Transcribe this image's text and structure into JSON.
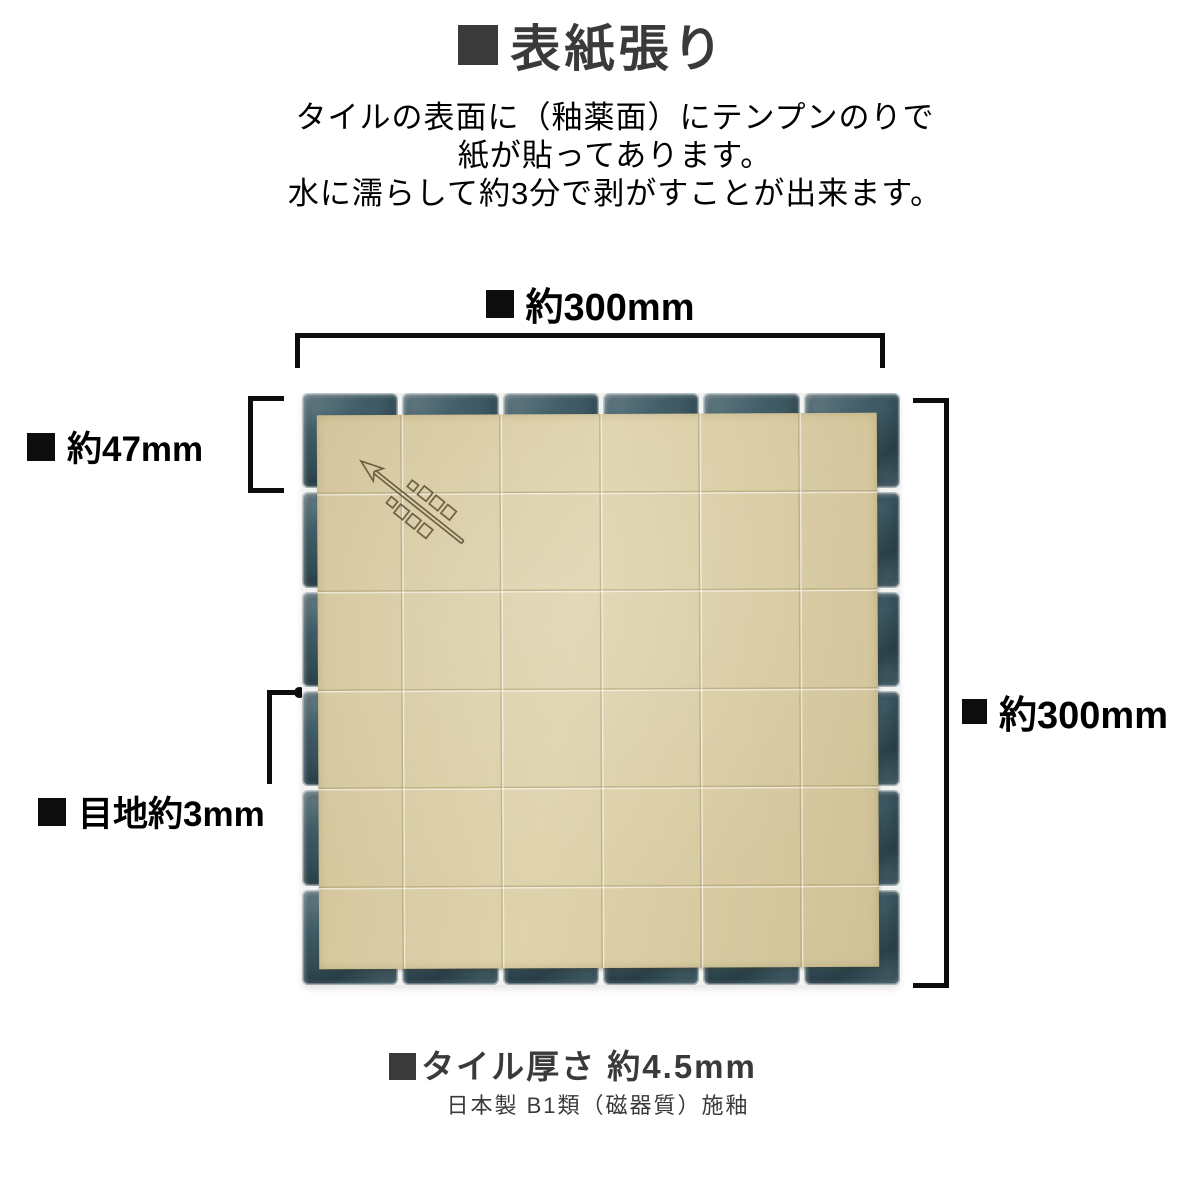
{
  "title": {
    "text": "表紙張り"
  },
  "description": {
    "line1": "タイルの表面に（釉薬面）にテンプンのりで",
    "line2": "紙が貼ってあります。",
    "line3": "水に濡らして約3分で剥がすことが出来ます。"
  },
  "diagram": {
    "labels": {
      "width_top": "約300mm",
      "height_right": "約300mm",
      "tile_size": "約47mm",
      "joint": "目地約3mm"
    },
    "tile_grid": {
      "rows": 6,
      "cols": 6
    },
    "colors": {
      "tile": "#3a5863",
      "grout": "#f3f3f1",
      "paper": "#dccfa5",
      "stamp": "#6f6045",
      "annotation": "#0d0d0d",
      "heading": "#3a3a3a"
    }
  },
  "footer": {
    "thickness": "タイル厚さ 約4.5mm",
    "spec": "日本製 B1類（磁器質）施釉"
  }
}
